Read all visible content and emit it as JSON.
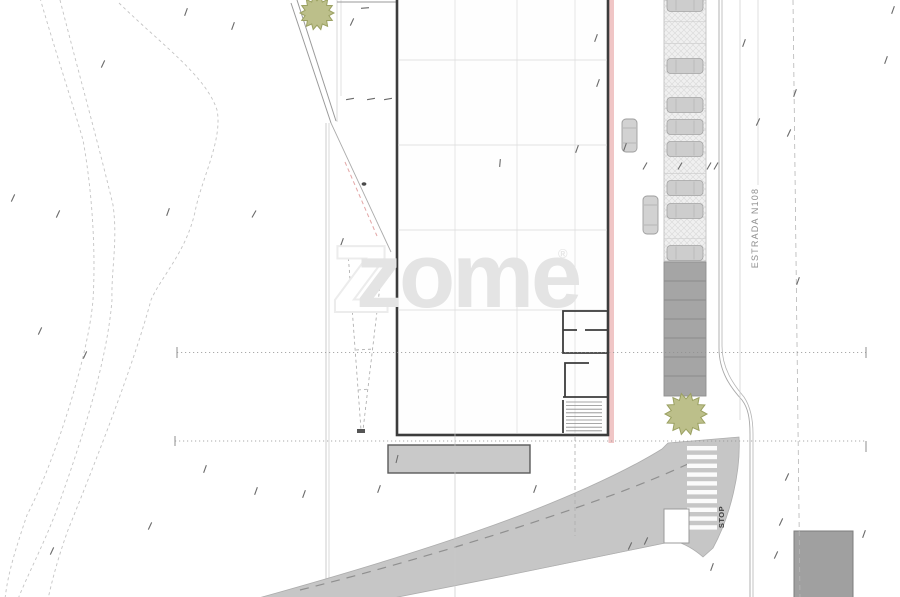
{
  "title": "Architectural site plan",
  "watermark": {
    "text": "zome",
    "reg": "®",
    "color": "#e4e4e4"
  },
  "labels": {
    "road_name": "ESTRADA N108",
    "stop": "STOP"
  },
  "colors": {
    "paper": "#ffffff",
    "wall": "#3c3c3c",
    "pink_accent": "#f0c6c6",
    "road_gray": "#c6c6c6",
    "parking_dark": "#a5a5a5",
    "parking_light": "#f0f0f0",
    "dock_gray": "#c9c9c9",
    "building_right_gray": "#a0a0a0",
    "tree_fill": "#bcbf8a",
    "tree_edge": "#9aa061",
    "contour_line": "#c4c4c4",
    "dim_line": "#8f8f8f"
  },
  "trees": [
    {
      "cx": 317,
      "cy": 13,
      "r": 17
    },
    {
      "cx": 686,
      "cy": 414,
      "r": 21
    }
  ],
  "parking": {
    "strip_x": 664,
    "strip_w": 42,
    "hatch_top": 0,
    "hatch_h": 261,
    "divider_step": 21.7,
    "cars_y": [
      4,
      66,
      105,
      127,
      149,
      188,
      211,
      253
    ],
    "car_w": 36,
    "car_h": 15,
    "dark_top": 262,
    "dark_h": 134,
    "dark_divider_step": 19
  },
  "street_cars": [
    {
      "x": 622,
      "y": 119,
      "w": 15,
      "h": 33
    },
    {
      "x": 643,
      "y": 196,
      "w": 15,
      "h": 38
    }
  ],
  "crosswalk": {
    "x": 687,
    "w": 30,
    "y_start": 446,
    "step": 8.8,
    "stripe_h": 4.4,
    "count": 10
  },
  "stairs": {
    "x1": 566,
    "x2": 602,
    "y_start": 402,
    "step": 3.6,
    "count": 9
  },
  "marks": [
    [
      186,
      12,
      20
    ],
    [
      352,
      22,
      25
    ],
    [
      596,
      38,
      20
    ],
    [
      744,
      43,
      20
    ],
    [
      893,
      10,
      20
    ],
    [
      598,
      83,
      20
    ],
    [
      758,
      122,
      25
    ],
    [
      789,
      133,
      25
    ],
    [
      625,
      147,
      20
    ],
    [
      577,
      149,
      20
    ],
    [
      13,
      198,
      25
    ],
    [
      58,
      214,
      25
    ],
    [
      168,
      212,
      20
    ],
    [
      254,
      214,
      30
    ],
    [
      40,
      331,
      25
    ],
    [
      85,
      355,
      25
    ],
    [
      150,
      526,
      25
    ],
    [
      52,
      551,
      25
    ],
    [
      205,
      469,
      20
    ],
    [
      256,
      491,
      20
    ],
    [
      304,
      494,
      20
    ],
    [
      379,
      489,
      20
    ],
    [
      535,
      489,
      20
    ],
    [
      646,
      541,
      25
    ],
    [
      630,
      546,
      25
    ],
    [
      712,
      567,
      20
    ],
    [
      795,
      93,
      20
    ],
    [
      798,
      281,
      20
    ],
    [
      787,
      477,
      25
    ],
    [
      781,
      522,
      25
    ],
    [
      776,
      555,
      25
    ],
    [
      864,
      534,
      20
    ],
    [
      365,
      8,
      85
    ],
    [
      500,
      163,
      5
    ],
    [
      350,
      99,
      80
    ],
    [
      371,
      99,
      80
    ],
    [
      388,
      99,
      80
    ],
    [
      645,
      166,
      30
    ],
    [
      680,
      166,
      30
    ],
    [
      709,
      166,
      30
    ],
    [
      716,
      166,
      30
    ],
    [
      342,
      242,
      20
    ],
    [
      233,
      26,
      20
    ],
    [
      103,
      64,
      25
    ],
    [
      886,
      60,
      20
    ]
  ]
}
